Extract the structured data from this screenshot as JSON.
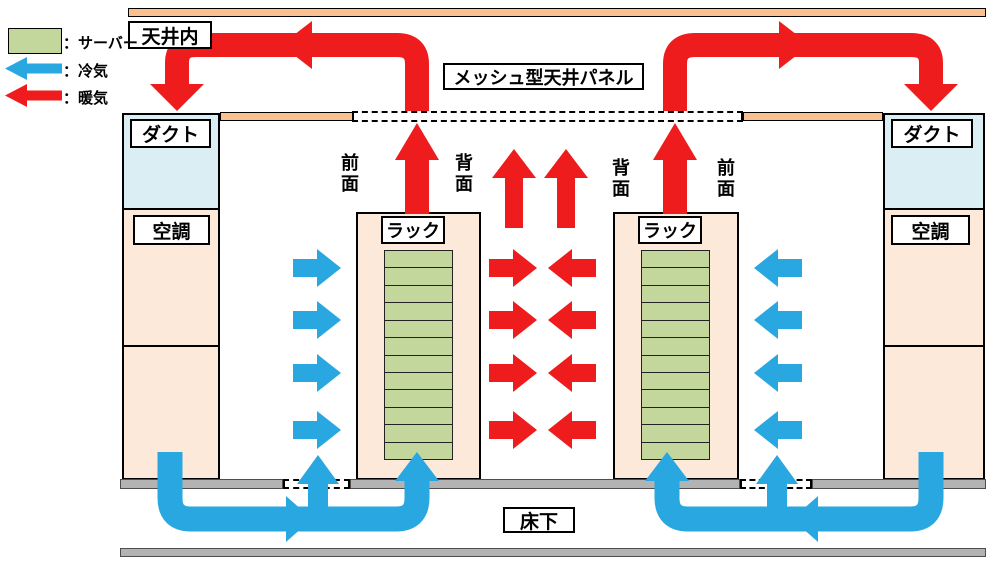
{
  "legend": {
    "server": "：サーバー",
    "cold_air": "：冷気",
    "warm_air": "：暖気"
  },
  "labels": {
    "ceiling_space": "天井内",
    "mesh_ceiling_panel": "メッシュ型天井パネル",
    "duct_left": "ダクト",
    "duct_right": "ダクト",
    "ac_left": "空調",
    "ac_right": "空調",
    "rack_left": "ラック",
    "rack_right": "ラック",
    "rack_left_front": "前面",
    "rack_left_back": "背面",
    "rack_right_back": "背面",
    "rack_right_front": "前面",
    "underfloor": "床下"
  },
  "racks": {
    "rack_count": 2,
    "server_units_per_rack": 12
  },
  "colors": {
    "warm_air": "#ee1c1c",
    "cold_air": "#29a7e0",
    "server": "#c3d69b",
    "room": "#fde9d9",
    "ceiling_slab": "#fac090",
    "duct": "#daeef3",
    "floor": "#b3b3b3"
  }
}
